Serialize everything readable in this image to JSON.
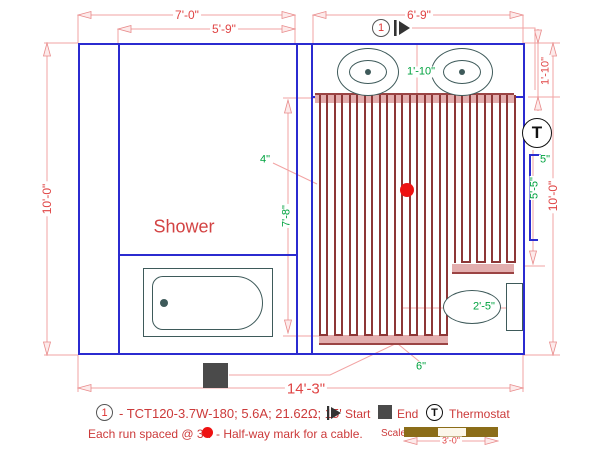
{
  "colors": {
    "wall": "#2b2bd0",
    "dimension_line": "#f2a3a3",
    "dimension_text": "#e04545",
    "annotation_green": "#00a23f",
    "cable_run": "#8d3636",
    "cable_band": "#e3aeae",
    "fixture_outline": "#3e5a5a",
    "marker_dark": "#4a4a4a",
    "scale_brown": "#8b6d18",
    "halfway_dot": "#ee1111",
    "legend_red": "#cc3a3a"
  },
  "plan": {
    "room_label": "Shower",
    "start_marker_number": "1",
    "thermostat_letter": "T",
    "dims": {
      "top_left": "7'-0\"",
      "top_left_inner": "5'-9\"",
      "top_right": "6'-9\"",
      "left_height": "10'-0\"",
      "right_height": "10'-0\"",
      "right_top": "1'-10\"",
      "bottom": "14'-3\""
    },
    "notes": {
      "sink_gap": "1'-10\"",
      "edge_gap": "4\"",
      "mat_height": "7'-8\"",
      "right_edge_gap": "5\"",
      "right_mat_height": "5'-5\"",
      "toilet_clearance": "2'-5\"",
      "bottom_gap": "6\""
    }
  },
  "cable": {
    "runs": 27,
    "long_runs": 18,
    "start_x": 318.5,
    "spacing_px": 7.5,
    "top_y": 95,
    "long_bottom_y": 336,
    "short_bottom_y": 263
  },
  "legend": {
    "item_number": "1",
    "spec": "- TCT120-3.7W-180; 5.6A; 21.62Ω; 15'",
    "start_label": "Start",
    "end_label": "End",
    "thermostat_label": "Thermostat",
    "run_spacing_note": "Each run spaced @ 3\".",
    "halfway_note": "- Half-way mark for a cable.",
    "scale_label": "Scale",
    "scale_length": "3'-0\""
  }
}
